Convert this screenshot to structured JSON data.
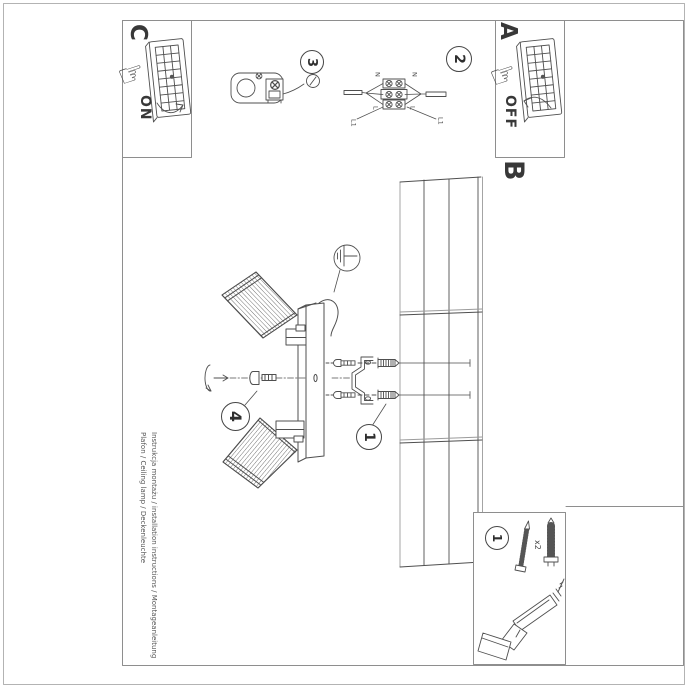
{
  "document": {
    "product_line1": "Instrukcja montażu / installation instructions / Montageanleitung",
    "product_line2": "Plafon / Ceiling lamp / Deckenleuchte"
  },
  "panels": {
    "switch_on": {
      "label": "C",
      "state": "ON"
    },
    "switch_off": {
      "label": "A",
      "state": "OFF"
    },
    "ceiling": {
      "label": "B"
    }
  },
  "steps": {
    "mount": "1",
    "wiring": "2",
    "canopy": "3",
    "adjust": "4",
    "parts": "1"
  },
  "wiring_labels": {
    "n_left": "N",
    "n_right": "N",
    "l_left": "L",
    "l_right": "L",
    "l1_left": "L1",
    "l1_right": "L1"
  },
  "parts": {
    "screw_qty": "x2"
  },
  "colors": {
    "ink": "#3f3f3f",
    "frame": "#8e8e8e",
    "light_line": "#9b9b9b"
  }
}
